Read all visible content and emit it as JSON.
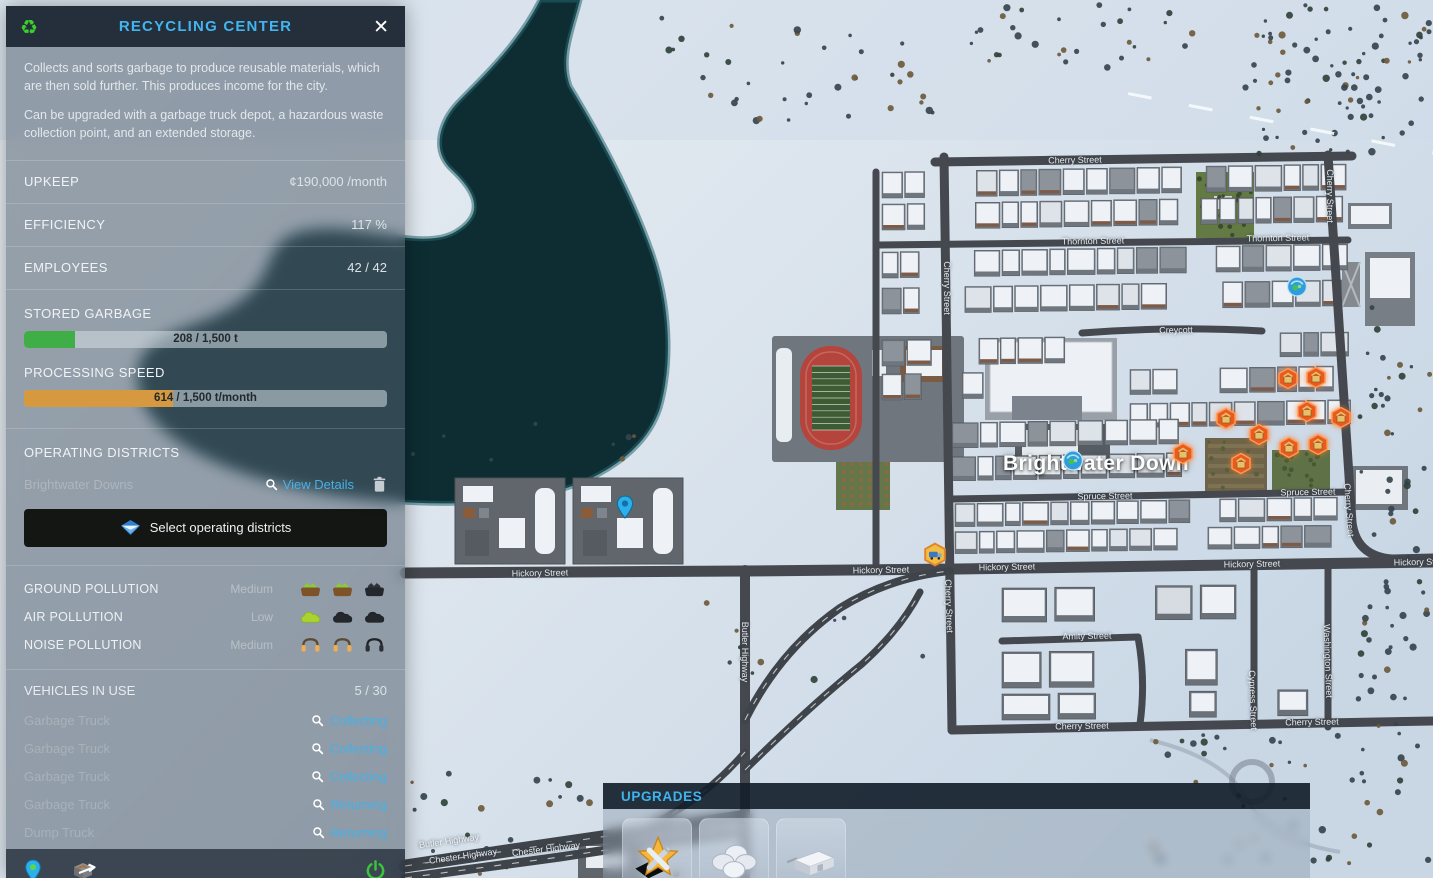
{
  "panel": {
    "title": "RECYCLING CENTER",
    "close": "✕",
    "description_1": "Collects and sorts garbage to produce reusable materials, which are then sold further. This produces income for the city.",
    "description_2": "Can be upgraded with a garbage truck depot, a hazardous waste collection point, and an extended storage.",
    "stats": [
      {
        "label": "UPKEEP",
        "value": "¢190,000 /month"
      },
      {
        "label": "EFFICIENCY",
        "value": "117 %"
      },
      {
        "label": "EMPLOYEES",
        "value": "42 / 42"
      }
    ],
    "stored_garbage": {
      "label": "STORED GARBAGE",
      "value_text": "208 / 1,500 t",
      "percent": 14,
      "color": "#3fae46"
    },
    "processing_speed": {
      "label": "PROCESSING SPEED",
      "value_text": "614 / 1,500 t/month",
      "percent": 41,
      "color": "#d6993f"
    },
    "districts": {
      "heading": "OPERATING DISTRICTS",
      "name": "Brightwater Downs",
      "view_details": "View Details",
      "select_button": "Select operating districts"
    },
    "pollution": {
      "rows": [
        {
          "label": "GROUND POLLUTION",
          "level": "Medium",
          "type": "ground",
          "active": 2,
          "total": 3
        },
        {
          "label": "AIR POLLUTION",
          "level": "Low",
          "type": "air",
          "active": 1,
          "total": 3
        },
        {
          "label": "NOISE POLLUTION",
          "level": "Medium",
          "type": "noise",
          "active": 2,
          "total": 3
        }
      ]
    },
    "vehicles": {
      "heading": "VEHICLES IN USE",
      "count": "5 / 30",
      "rows": [
        {
          "name": "Garbage Truck",
          "status": "Collecting"
        },
        {
          "name": "Garbage Truck",
          "status": "Collecting"
        },
        {
          "name": "Garbage Truck",
          "status": "Collecting"
        },
        {
          "name": "Garbage Truck",
          "status": "Returning"
        },
        {
          "name": "Dump Truck",
          "status": "Returning"
        }
      ]
    }
  },
  "upgrades": {
    "title": "UPGRADES",
    "items": [
      {
        "icon": "star-tools-upgrade-icon"
      },
      {
        "icon": "domes-upgrade-icon"
      },
      {
        "icon": "storage-upgrade-icon"
      }
    ]
  },
  "map": {
    "district_label": "Brightwater Down",
    "street_labels": [
      {
        "text": "Cherry Street",
        "x": 1075,
        "y": 160,
        "rot": -1
      },
      {
        "text": "Cherry Street",
        "x": 1330,
        "y": 196,
        "rot": 90
      },
      {
        "text": "Thornton Street",
        "x": 1093,
        "y": 241,
        "rot": -1
      },
      {
        "text": "Thornton Street",
        "x": 1278,
        "y": 238,
        "rot": -1
      },
      {
        "text": "Creycott",
        "x": 1176,
        "y": 330,
        "rot": -1
      },
      {
        "text": "Cherry Street",
        "x": 947,
        "y": 288,
        "rot": 90
      },
      {
        "text": "Spruce Street",
        "x": 1105,
        "y": 496,
        "rot": -1
      },
      {
        "text": "Spruce Street",
        "x": 1308,
        "y": 492,
        "rot": -1
      },
      {
        "text": "Cherry Street",
        "x": 1349,
        "y": 510,
        "rot": 86
      },
      {
        "text": "Hickory Street",
        "x": 540,
        "y": 573,
        "rot": -1
      },
      {
        "text": "Hickory Street",
        "x": 881,
        "y": 570,
        "rot": -1
      },
      {
        "text": "Hickory Street",
        "x": 1007,
        "y": 567,
        "rot": -1
      },
      {
        "text": "Hickory Street",
        "x": 1252,
        "y": 564,
        "rot": -1
      },
      {
        "text": "Hickory Street",
        "x": 1422,
        "y": 562,
        "rot": -1
      },
      {
        "text": "Cherry Street",
        "x": 949,
        "y": 606,
        "rot": 88
      },
      {
        "text": "Amity Street",
        "x": 1087,
        "y": 636,
        "rot": -1
      },
      {
        "text": "Washington Street",
        "x": 1328,
        "y": 661,
        "rot": 88
      },
      {
        "text": "Cypress Street",
        "x": 1253,
        "y": 700,
        "rot": 88
      },
      {
        "text": "Cherry Street",
        "x": 1082,
        "y": 726,
        "rot": -1
      },
      {
        "text": "Cherry Street",
        "x": 1312,
        "y": 722,
        "rot": -1
      },
      {
        "text": "Butler Highway",
        "x": 449,
        "y": 841,
        "rot": -8
      },
      {
        "text": "Chester Highway",
        "x": 463,
        "y": 856,
        "rot": -8
      },
      {
        "text": "Chester Highway",
        "x": 546,
        "y": 849,
        "rot": -7
      },
      {
        "text": "Butler Highway",
        "x": 745,
        "y": 652,
        "rot": 90
      }
    ],
    "warning_icons": [
      [
        1183,
        456
      ],
      [
        1241,
        466
      ],
      [
        1226,
        421
      ],
      [
        1259,
        437
      ],
      [
        1289,
        450
      ],
      [
        1318,
        447
      ],
      [
        1341,
        420
      ],
      [
        1307,
        414
      ],
      [
        1288,
        381
      ],
      [
        1316,
        380
      ]
    ],
    "truck_icon": {
      "x": 935,
      "y": 557
    },
    "pin_icon": {
      "x": 625,
      "y": 510
    },
    "service_icons": [
      [
        1297,
        289
      ],
      [
        1073,
        463
      ]
    ]
  },
  "colors": {
    "accent_cyan": "#45b1e8",
    "title_cyan": "#42b4ee",
    "bar_green": "#3fae46",
    "bar_orange": "#d6993f",
    "warning_orange": "#e85a20",
    "power_green": "#38c53c"
  }
}
